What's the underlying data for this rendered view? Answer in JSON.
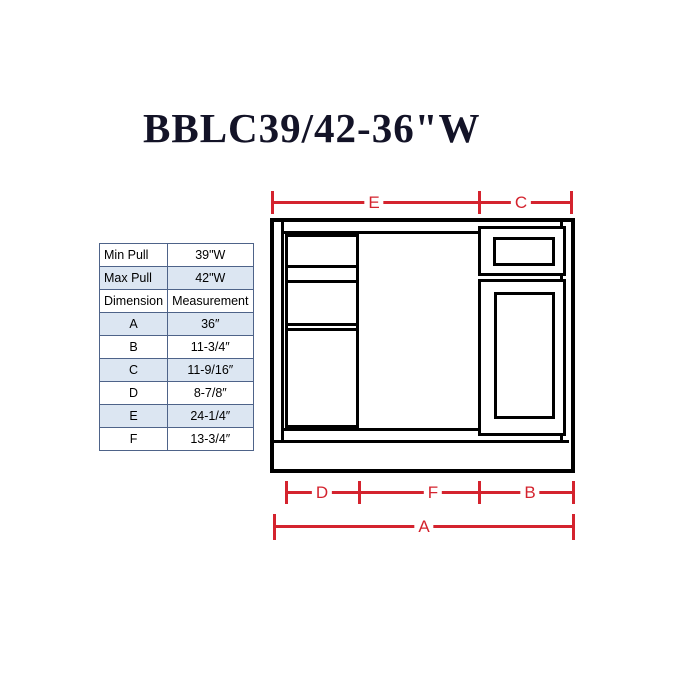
{
  "title": "BBLC39/42-36\"W",
  "table": {
    "rows": [
      {
        "label": "Min Pull",
        "value": "39\"W",
        "shaded": false,
        "align": "left"
      },
      {
        "label": "Max Pull",
        "value": "42\"W",
        "shaded": true,
        "align": "left"
      },
      {
        "label": "Dimension",
        "value": "Measurement",
        "shaded": false,
        "align": "left"
      },
      {
        "label": "A",
        "value": "36″",
        "shaded": true,
        "align": "center"
      },
      {
        "label": "B",
        "value": "11-3/4″",
        "shaded": false,
        "align": "center"
      },
      {
        "label": "C",
        "value": "11-9/16″",
        "shaded": true,
        "align": "center"
      },
      {
        "label": "D",
        "value": "8-7/8″",
        "shaded": false,
        "align": "center"
      },
      {
        "label": "E",
        "value": "24-1/4″",
        "shaded": true,
        "align": "center"
      },
      {
        "label": "F",
        "value": "13-3/4″",
        "shaded": false,
        "align": "center"
      }
    ]
  },
  "diagram": {
    "dimension_labels": {
      "top_left": "E",
      "top_right": "C",
      "bottom_left": "D",
      "bottom_mid": "F",
      "bottom_right": "B",
      "overall": "A"
    }
  },
  "colors": {
    "dimension_red": "#d4232e",
    "table_row_shade": "#dce6f2",
    "table_border": "#4e6389",
    "line_black": "#000000",
    "title_color": "#131327"
  }
}
